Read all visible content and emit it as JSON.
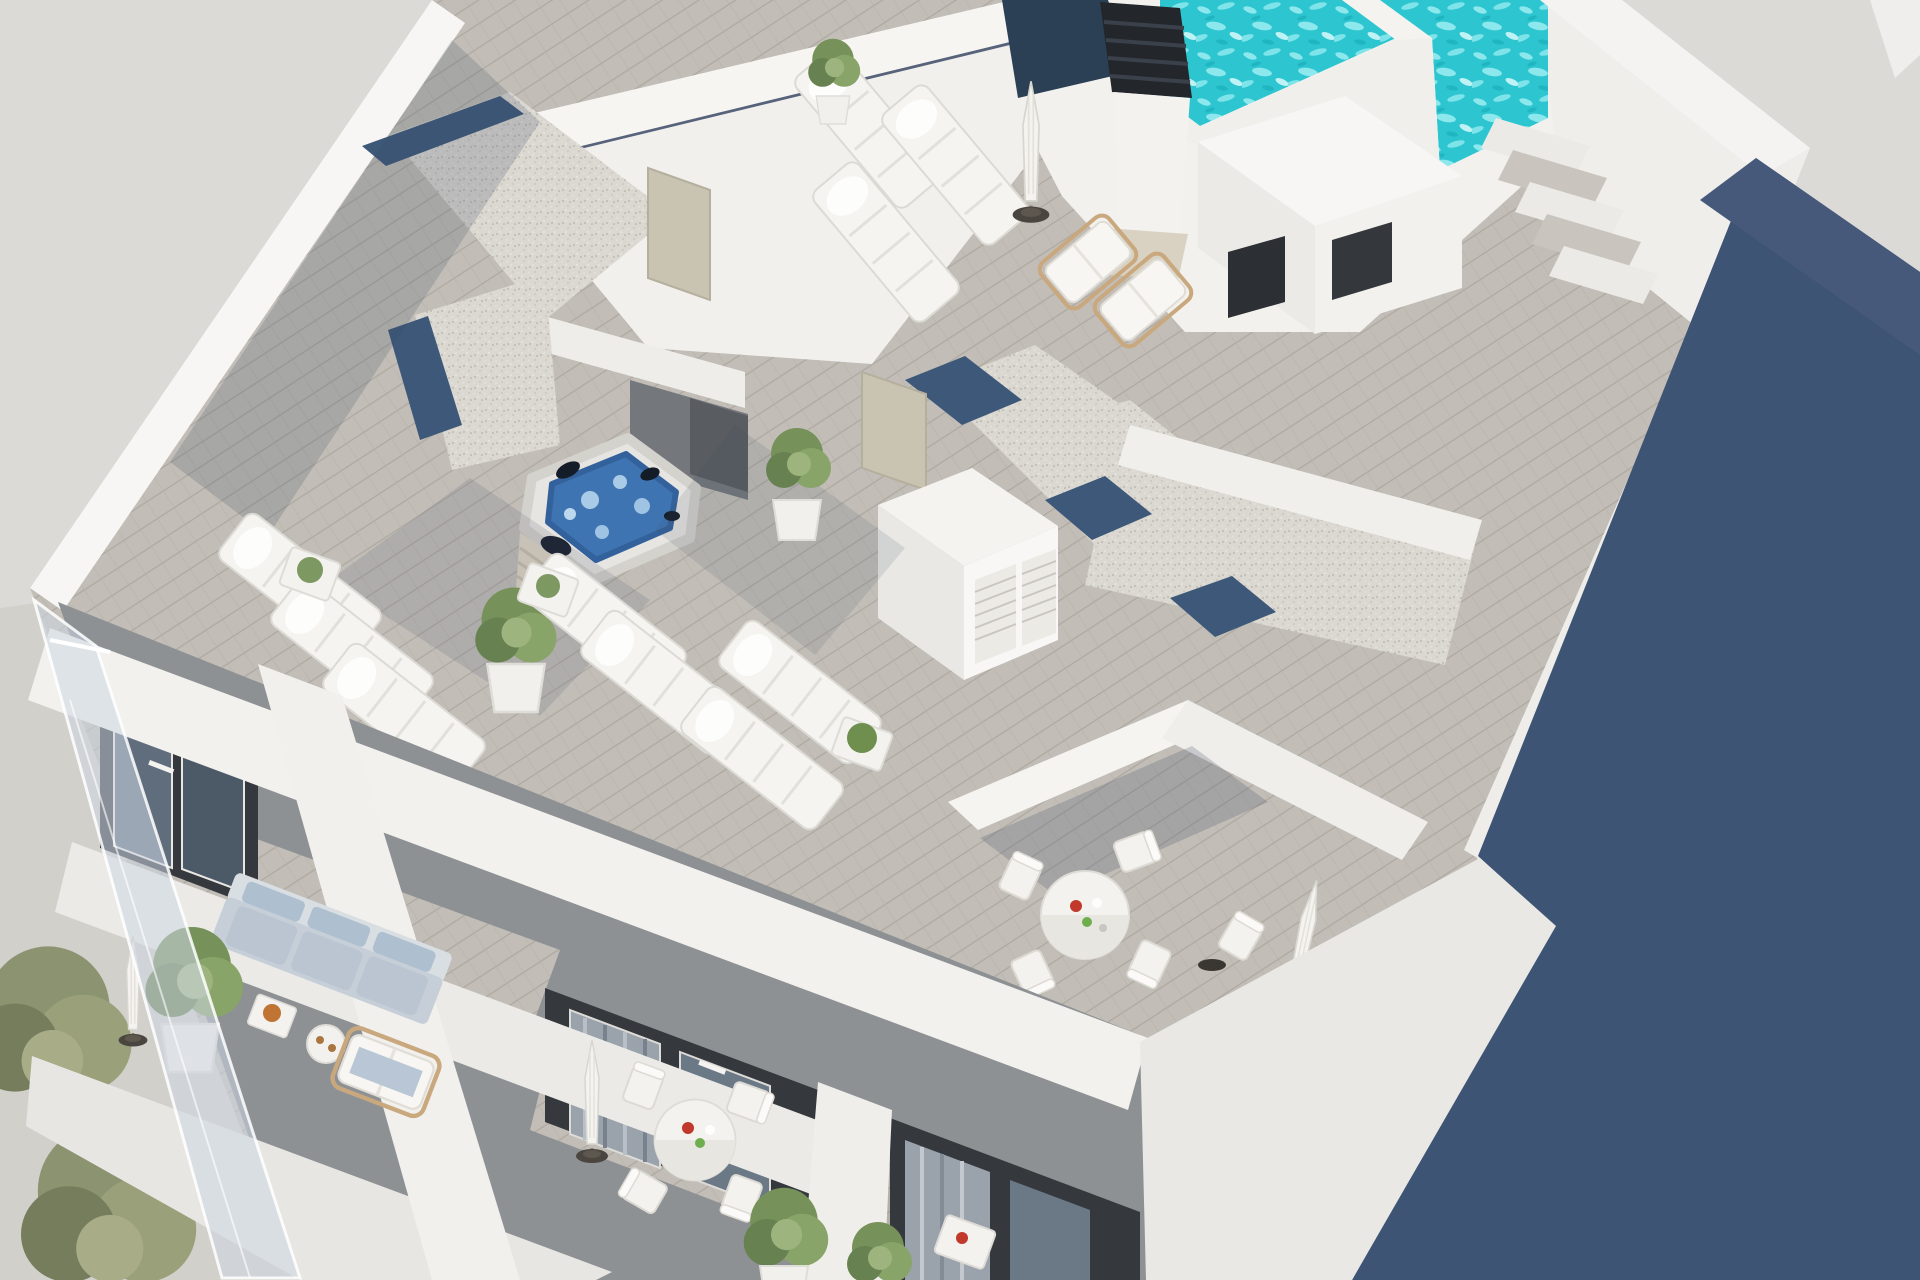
{
  "meta": {
    "title": "Aerial 3D architectural render of rooftop terraces",
    "image_type": "photorealistic CGI visualization",
    "visible_text": "none"
  },
  "palette": {
    "background": "#dcdad6",
    "street": "#d2d0cb",
    "building_white": "#f2f1ee",
    "wall_bright": "#f7f6f4",
    "wall_shade": "#e9e8e4",
    "deck_wood": "#c2beb7",
    "deck_plank_line": "#afaba3",
    "deck_shadowed": "#57637a",
    "gravel": "#dbd8d1",
    "gravel_dot": "#b5b1a8",
    "skylight_navy": "#3d5878",
    "pool_water": "#2cc5d0",
    "pool_ripple": "#8ce8ec",
    "jacuzzi_water": "#3e74b2",
    "jacuzzi_foam": "#a9cbe8",
    "shadow_navy": "#3e5474",
    "facade_dark": "#35383c",
    "glass_gray": "#5f6d7c",
    "curtain_gray": "#9aa2ab",
    "sofa_gray_blue": "#c6cfd8",
    "cushion_blue": "#b9c6d6",
    "plant_green": "#7d9861",
    "plant_olive": "#8b9370",
    "wood_tan": "#c19b6c",
    "door_beige": "#c9c3b2",
    "umbrella_white": "#f4f3ef",
    "base_dark": "#3a3632",
    "accent_red": "#c0392b",
    "accent_green": "#6fae4e",
    "bowl_orange": "#bf7433",
    "chimney_dark": "#23272b",
    "shadow_overlay": "rgba(62,74,98,0.20)"
  },
  "scene": {
    "description": "Top-down aerial cutaway render of the penthouse roof level of a modern white apartment building: turquoise swimming pool top right, louvered chimney, gravel flat roofs with navy skylight strips, grey wood-plank solarium terraces with white sun loungers, a blue hot tub in a shaded alcove, round dining sets, potted plants, lower-floor balconies with a blue-grey sofa at bottom left, street trees in the corner and a large slate-blue shadow cast to the right.",
    "areas": [
      {
        "id": "pool-deck",
        "label": "rooftop pool deck"
      },
      {
        "id": "solarium-west",
        "label": "west solarium terrace with loungers"
      },
      {
        "id": "jacuzzi-patio",
        "label": "jacuzzi patio in shaded alcove"
      },
      {
        "id": "gravel-roofs",
        "label": "gravel flat roofs with navy skylight strips"
      },
      {
        "id": "terrace-southeast",
        "label": "private south-east terrace with dining set"
      },
      {
        "id": "walkway-east",
        "label": "east timber walkway with steps"
      },
      {
        "id": "balconies-lower",
        "label": "lower floor balconies"
      },
      {
        "id": "street",
        "label": "street corner with trees"
      }
    ],
    "objects": {
      "swimming_pool_basins": 2,
      "hot_tub": 1,
      "sun_loungers": 10,
      "wooden_deck_chairs": 3,
      "closed_umbrellas": 4,
      "round_dining_tables": 3,
      "side_tables": 6,
      "dining_chairs": 9,
      "sofa": 1,
      "potted_plants": 9,
      "street_trees": 2,
      "gravel_roofs": 2,
      "skylight_strips": 5,
      "louvered_chimney": 1,
      "stair_treads": 5,
      "louver_shutter_panels": 2,
      "roof_access_doors": 2,
      "dark_facade_panels": 3,
      "glass_balustrade": 1
    }
  }
}
